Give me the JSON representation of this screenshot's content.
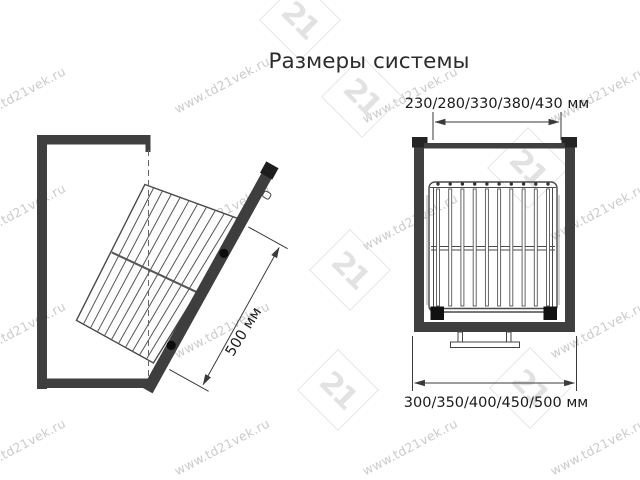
{
  "title": "Размеры системы",
  "watermark": {
    "text": "www.td21vek.ru"
  },
  "logo": {
    "text": "21"
  },
  "diagrams": {
    "side_view": {
      "depth_dimension_label": "500 мм"
    },
    "front_view": {
      "inner_width_dimension_label": "230/280/330/380/430 мм",
      "outer_width_dimension_label": "300/350/400/450/500 мм"
    }
  },
  "colors": {
    "frame": "#3f3f3f",
    "drawing_line": "#444444",
    "dimension_text": "#1b1b1b",
    "watermark": "#cbcbcb",
    "logo": "#e4e4e4",
    "background": "#ffffff"
  }
}
